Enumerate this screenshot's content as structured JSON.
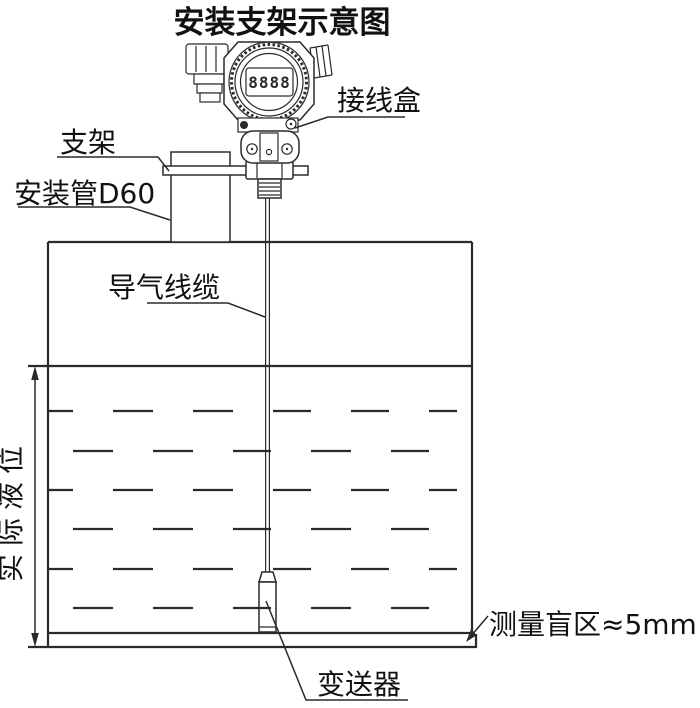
{
  "title": "安装支架示意图",
  "colors": {
    "line": "#2a2a2a",
    "text": "#111111",
    "background": "#ffffff"
  },
  "head": {
    "display_digits": "8888"
  },
  "labels": {
    "junction_box": "接线盒",
    "bracket": "支架",
    "mounting_pipe": "安装管D60",
    "air_cable": "导气线缆",
    "actual_level": "实际液位",
    "blind_zone": "测量盲区≈5mm",
    "transmitter": "变送器"
  }
}
